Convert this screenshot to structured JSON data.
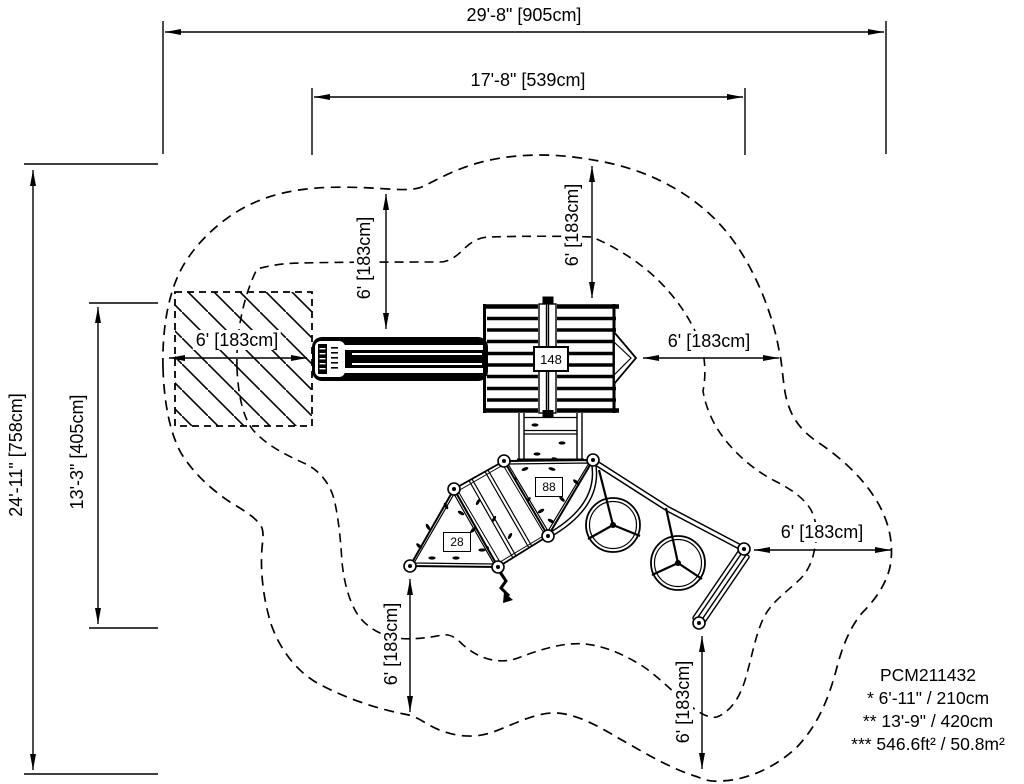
{
  "drawing": {
    "model": "PCM211432",
    "notes": {
      "line1": "* 6'-11\" / 210cm",
      "line2": "** 13'-9\" / 420cm",
      "line3": "*** 546.6ft² / 50.8m²"
    },
    "dimensions": {
      "overall_width": "29'-8\" [905cm]",
      "equipment_width": "17'-8\" [539cm]",
      "overall_height": "24'-11\" [758cm]",
      "equipment_height": "13'-3\" [405cm]",
      "clearance": "6' [183cm]"
    },
    "equipment_labels": {
      "main_deck": "148",
      "triangle_deck_large": "88",
      "triangle_deck_small": "28"
    }
  }
}
